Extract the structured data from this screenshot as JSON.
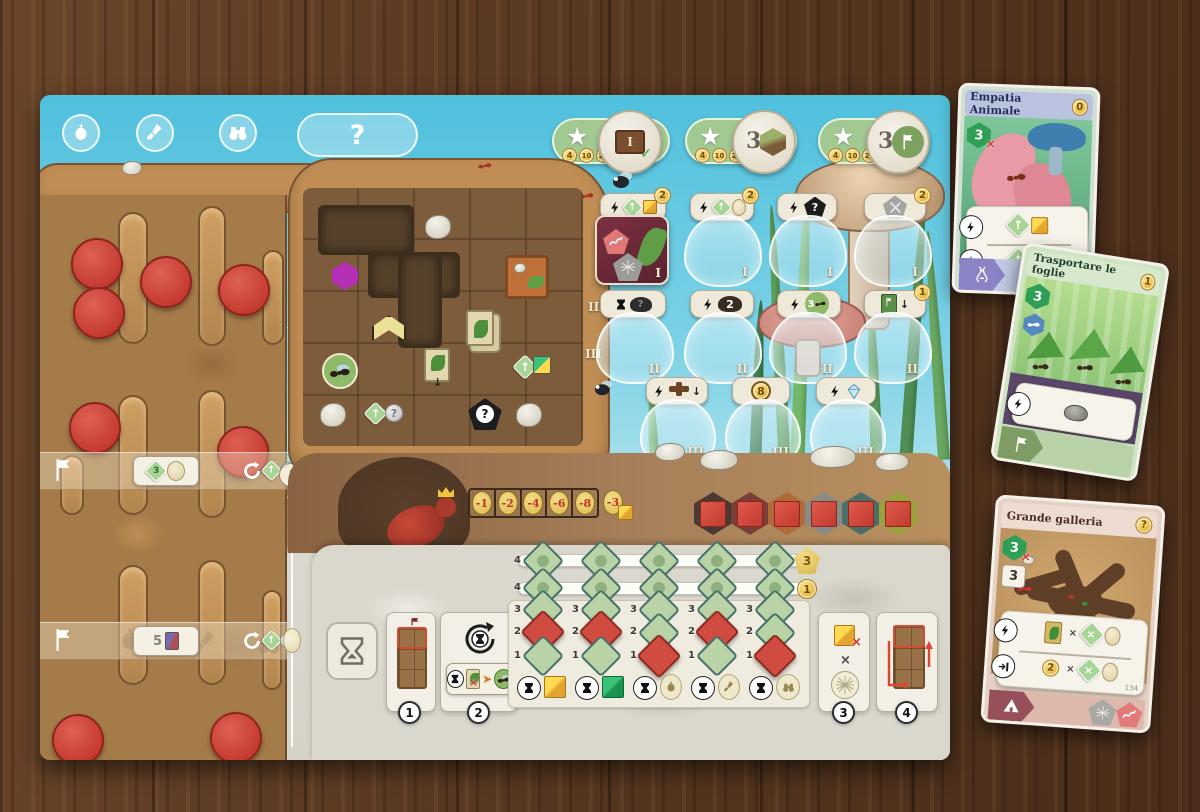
{
  "icons": {
    "star": "★",
    "check": "✓",
    "up": "↑",
    "down": "↓",
    "x": "×",
    "question": "?"
  },
  "board": {
    "actions_question": "?",
    "pills": [
      {
        "c1": "4",
        "c2": "10",
        "c3": "20",
        "d": "I"
      },
      {
        "c1": "4",
        "c2": "10",
        "c3": "20",
        "d": "3"
      },
      {
        "c1": "4",
        "c2": "10",
        "c3": "20",
        "d": "3"
      }
    ],
    "left": {
      "b1": "3",
      "b2": "5",
      "b3": "4"
    },
    "dig": {
      "n2": "II",
      "n3": "III"
    },
    "slots": {
      "r1": {
        "n": "I",
        "t1": "2",
        "t2": "2",
        "t4": "2"
      },
      "r2": {
        "n": "II",
        "t2": "2",
        "t3": "3",
        "t4": "1"
      },
      "r3": {
        "n": "III",
        "t2": "8"
      }
    },
    "penalty": [
      "-1",
      "-2",
      "-4",
      "-6",
      "-8",
      "-3"
    ],
    "rows": [
      "4",
      "4",
      "3",
      "2",
      "1"
    ],
    "badge_top": "3",
    "badge_mid": "1",
    "s1": "1",
    "s2": "2",
    "s3": "3",
    "s4": "4"
  },
  "cards": {
    "c1": {
      "title": "Empatia Animale",
      "cost": "0",
      "hex": "3"
    },
    "c2": {
      "title": "Trasportare le foglie",
      "cost": "1",
      "hex": "3"
    },
    "c3": {
      "title": "Grande galleria",
      "cost": "?",
      "hex": "3",
      "tile": "3",
      "coin": "2",
      "index": "134"
    }
  }
}
